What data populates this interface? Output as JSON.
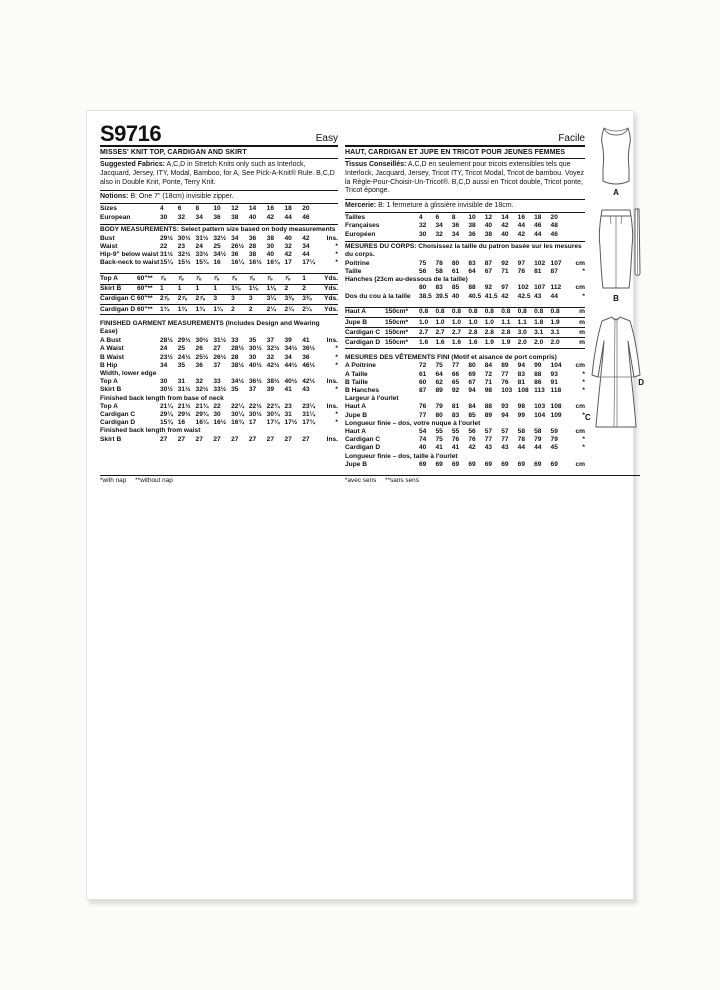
{
  "page": {
    "sku": "S9716"
  },
  "views": {
    "a": "A",
    "b": "B",
    "c": "C",
    "d": "D"
  },
  "english": {
    "difficulty": "Easy",
    "title": "MISSES' KNIT TOP, CARDIGAN AND SKIRT",
    "fabrics_label": "Suggested Fabrics:",
    "fabrics_text": "A,C,D in Stretch Knits only such as Interlock, Jacquard, Jersey, ITY, Modal, Bamboo, for A, See Pick-A-Knit® Rule. B,C,D also in Double Knit, Ponte, Terry Knit.",
    "notions_label": "Notions:",
    "notions_text": "B: One 7\" (18cm) invisible zipper.",
    "footnote": "*with nap     **without nap",
    "size_rows": [
      {
        "type": "row",
        "label": "Sizes",
        "values": [
          "4",
          "6",
          "8",
          "10",
          "12",
          "14",
          "16",
          "18",
          "20"
        ],
        "unit": ""
      },
      {
        "type": "row",
        "label": "European",
        "values": [
          "30",
          "32",
          "34",
          "36",
          "38",
          "40",
          "42",
          "44",
          "46"
        ],
        "unit": ""
      }
    ],
    "body_rows": [
      {
        "type": "header",
        "ruleTop": true,
        "text": "BODY MEASUREMENTS: Select pattern size based on body measurements"
      },
      {
        "type": "row",
        "label": "Bust",
        "values": [
          "29½",
          "30½",
          "31½",
          "32½",
          "34",
          "36",
          "38",
          "40",
          "42"
        ],
        "unit": "Ins."
      },
      {
        "type": "row",
        "label": "Waist",
        "values": [
          "22",
          "23",
          "24",
          "25",
          "26½",
          "28",
          "30",
          "32",
          "34"
        ],
        "unit": "*"
      },
      {
        "type": "row",
        "label": "Hip-9\" below waist",
        "values": [
          "31½",
          "32½",
          "33½",
          "34½",
          "36",
          "38",
          "40",
          "42",
          "44"
        ],
        "unit": "*"
      },
      {
        "type": "row",
        "label": "Back-neck to waist",
        "values": [
          "15¼",
          "15½",
          "15¾",
          "16",
          "16¼",
          "16½",
          "16¾",
          "17",
          "17¼"
        ],
        "unit": "*"
      }
    ],
    "yardage_rows": [
      {
        "type": "row",
        "ruleTop": true,
        "ruled": true,
        "label": "Top A",
        "spec": "60\"**",
        "values": [
          "⅞",
          "⅞",
          "⅞",
          "⅞",
          "⅞",
          "⅞",
          "⅞",
          "⅞",
          "1"
        ],
        "unit": "Yds."
      },
      {
        "type": "row",
        "ruled": true,
        "label": "Skirt B",
        "spec": "60\"**",
        "values": [
          "1",
          "1",
          "1",
          "1",
          "1⅛",
          "1⅛",
          "1⅛",
          "2",
          "2"
        ],
        "unit": "Yds."
      },
      {
        "type": "row",
        "ruled": true,
        "label": "Cardigan C",
        "spec": "60\"**",
        "values": [
          "2⅞",
          "2⅞",
          "2⅞",
          "3",
          "3",
          "3",
          "3¼",
          "3⅜",
          "3⅜"
        ],
        "unit": "Yds."
      },
      {
        "type": "row",
        "ruled": true,
        "label": "Cardigan D",
        "spec": "60\"**",
        "values": [
          "1¾",
          "1¾",
          "1¾",
          "1¾",
          "2",
          "2",
          "2¼",
          "2¼",
          "2¼"
        ],
        "unit": "Yds."
      }
    ],
    "finished_rows": [
      {
        "type": "header",
        "text": "FINISHED GARMENT MEASUREMENTS (Includes Design and Wearing Ease)"
      },
      {
        "type": "row",
        "label": "A Bust",
        "values": [
          "28½",
          "29½",
          "30½",
          "31½",
          "33",
          "35",
          "37",
          "39",
          "41"
        ],
        "unit": "Ins."
      },
      {
        "type": "row",
        "label": "A Waist",
        "values": [
          "24",
          "25",
          "26",
          "27",
          "28½",
          "30½",
          "32½",
          "34½",
          "36½"
        ],
        "unit": "*"
      },
      {
        "type": "row",
        "label": "B Waist",
        "values": [
          "23½",
          "24½",
          "25½",
          "26½",
          "28",
          "30",
          "32",
          "34",
          "36"
        ],
        "unit": "*"
      },
      {
        "type": "row",
        "label": "B Hip",
        "values": [
          "34",
          "35",
          "36",
          "37",
          "38½",
          "40½",
          "42½",
          "44½",
          "46½"
        ],
        "unit": "*"
      },
      {
        "type": "subhead",
        "text": "Width, lower edge"
      },
      {
        "type": "row",
        "label": "Top A",
        "values": [
          "30",
          "31",
          "32",
          "33",
          "34½",
          "36½",
          "38½",
          "40½",
          "42½"
        ],
        "unit": "Ins."
      },
      {
        "type": "row",
        "label": "Skirt B",
        "values": [
          "30½",
          "31½",
          "32½",
          "33½",
          "35",
          "37",
          "39",
          "41",
          "43"
        ],
        "unit": "*"
      },
      {
        "type": "subhead",
        "text": "Finished back length from base of neck"
      },
      {
        "type": "row",
        "label": "Top A",
        "values": [
          "21¼",
          "21½",
          "21¾",
          "22",
          "22¼",
          "22½",
          "22¾",
          "23",
          "23¼"
        ],
        "unit": "Ins."
      },
      {
        "type": "row",
        "label": "Cardigan C",
        "values": [
          "29¼",
          "29½",
          "29¾",
          "30",
          "30¼",
          "30½",
          "30¾",
          "31",
          "31¼"
        ],
        "unit": "*"
      },
      {
        "type": "row",
        "label": "Cardigan D",
        "values": [
          "15¾",
          "16",
          "16¼",
          "16½",
          "16¾",
          "17",
          "17¼",
          "17½",
          "17¾"
        ],
        "unit": "*"
      },
      {
        "type": "subhead",
        "text": "Finished back length from waist"
      },
      {
        "type": "row",
        "label": "Skirt B",
        "values": [
          "27",
          "27",
          "27",
          "27",
          "27",
          "27",
          "27",
          "27",
          "27"
        ],
        "unit": "Ins."
      }
    ]
  },
  "french": {
    "difficulty": "Facile",
    "title": "HAUT, CARDIGAN ET JUPE EN TRICOT POUR JEUNES FEMMES",
    "fabrics_label": "Tissus Conseillés:",
    "fabrics_text": "A,C,D en seulement pour tricots extensibles tels que Interlock, Jacquard, Jersey, Tricot ITY, Tricot Modal, Tricot de bambou. Voyez la Règle-Pour-Choisir-Un-Tricot®. B,C,D aussi en Tricot double, Tricot ponte, Tricot éponge.",
    "notions_label": "Mercerie:",
    "notions_text": "B: 1 fermeture à glissière invisible de 18cm.",
    "footnote": "*avec sens     **sans sens",
    "size_rows": [
      {
        "type": "row",
        "label": "Tailles",
        "values": [
          "4",
          "6",
          "8",
          "10",
          "12",
          "14",
          "16",
          "18",
          "20"
        ],
        "unit": ""
      },
      {
        "type": "row",
        "label": "Françaises",
        "values": [
          "32",
          "34",
          "36",
          "38",
          "40",
          "42",
          "44",
          "46",
          "48"
        ],
        "unit": ""
      },
      {
        "type": "row",
        "label": "Européen",
        "values": [
          "30",
          "32",
          "34",
          "36",
          "38",
          "40",
          "42",
          "44",
          "46"
        ],
        "unit": ""
      }
    ],
    "body_rows": [
      {
        "type": "header",
        "ruleTop": true,
        "text": "MESURES DU CORPS: Choisissez la taille du patron basée sur les mesures du corps."
      },
      {
        "type": "row",
        "label": "Poitrine",
        "values": [
          "75",
          "78",
          "80",
          "83",
          "87",
          "92",
          "97",
          "102",
          "107"
        ],
        "unit": "cm"
      },
      {
        "type": "row",
        "label": "Taille",
        "values": [
          "56",
          "58",
          "61",
          "64",
          "67",
          "71",
          "76",
          "81",
          "87"
        ],
        "unit": "*"
      },
      {
        "type": "subhead",
        "text": "Hanches (23cm au-dessous de la taille)"
      },
      {
        "type": "row",
        "label": "",
        "values": [
          "80",
          "83",
          "85",
          "88",
          "92",
          "97",
          "102",
          "107",
          "112"
        ],
        "unit": "cm"
      },
      {
        "type": "row",
        "label": "Dos du cou à la taille",
        "values": [
          "38.5",
          "39.5",
          "40",
          "40.5",
          "41.5",
          "42",
          "42.5",
          "43",
          "44"
        ],
        "unit": "*"
      }
    ],
    "yardage_rows": [
      {
        "type": "row",
        "ruleTop": true,
        "ruled": true,
        "label": "Haut A",
        "spec": "150cm*",
        "values": [
          "0.8",
          "0.8",
          "0.8",
          "0.8",
          "0.8",
          "0.8",
          "0.8",
          "0.8",
          "0.8"
        ],
        "unit": "m"
      },
      {
        "type": "row",
        "ruled": true,
        "label": "Jupe B",
        "spec": "150cm*",
        "values": [
          "1.0",
          "1.0",
          "1.0",
          "1.0",
          "1.0",
          "1.1",
          "1.1",
          "1.8",
          "1.9"
        ],
        "unit": "m"
      },
      {
        "type": "row",
        "ruled": true,
        "label": "Cardigan C",
        "spec": "150cm*",
        "values": [
          "2.7",
          "2.7",
          "2.7",
          "2.8",
          "2.8",
          "2.8",
          "3.0",
          "3.1",
          "3.1"
        ],
        "unit": "m"
      },
      {
        "type": "row",
        "ruled": true,
        "label": "Cardigan D",
        "spec": "150cm*",
        "values": [
          "1.6",
          "1.6",
          "1.6",
          "1.6",
          "1.9",
          "1.9",
          "2.0",
          "2.0",
          "2.0"
        ],
        "unit": "m"
      }
    ],
    "finished_rows": [
      {
        "type": "header",
        "text": "MESURES DES VÊTEMENTS FINI (Motif et aisance de port compris)"
      },
      {
        "type": "row",
        "label": "A Poitrine",
        "values": [
          "72",
          "75",
          "77",
          "80",
          "84",
          "89",
          "94",
          "99",
          "104"
        ],
        "unit": "cm"
      },
      {
        "type": "row",
        "label": "A Taille",
        "values": [
          "61",
          "64",
          "66",
          "69",
          "72",
          "77",
          "83",
          "88",
          "93"
        ],
        "unit": "*"
      },
      {
        "type": "row",
        "label": "B Taille",
        "values": [
          "60",
          "62",
          "65",
          "67",
          "71",
          "76",
          "81",
          "86",
          "91"
        ],
        "unit": "*"
      },
      {
        "type": "row",
        "label": "B Hanches",
        "values": [
          "87",
          "89",
          "92",
          "94",
          "98",
          "103",
          "108",
          "113",
          "118"
        ],
        "unit": "*"
      },
      {
        "type": "subhead",
        "text": "Largeur à l'ourlet"
      },
      {
        "type": "row",
        "label": "Haut A",
        "values": [
          "76",
          "79",
          "81",
          "84",
          "88",
          "93",
          "98",
          "103",
          "108"
        ],
        "unit": "cm"
      },
      {
        "type": "row",
        "label": "Jupe B",
        "values": [
          "77",
          "80",
          "83",
          "85",
          "89",
          "94",
          "99",
          "104",
          "109"
        ],
        "unit": "*"
      },
      {
        "type": "subhead",
        "text": "Longueur finie – dos, votre nuque à l'ourlet"
      },
      {
        "type": "row",
        "label": "Haut A",
        "values": [
          "54",
          "55",
          "55",
          "56",
          "57",
          "57",
          "58",
          "58",
          "59"
        ],
        "unit": "cm"
      },
      {
        "type": "row",
        "label": "Cardigan C",
        "values": [
          "74",
          "75",
          "76",
          "76",
          "77",
          "77",
          "78",
          "79",
          "79"
        ],
        "unit": "*"
      },
      {
        "type": "row",
        "label": "Cardigan D",
        "values": [
          "40",
          "41",
          "41",
          "42",
          "43",
          "43",
          "44",
          "44",
          "45"
        ],
        "unit": "*"
      },
      {
        "type": "subhead",
        "text": "Longueur finie – dos, taille à l'ourlet"
      },
      {
        "type": "row",
        "label": "Jupe B",
        "values": [
          "69",
          "69",
          "69",
          "69",
          "69",
          "69",
          "69",
          "69",
          "69"
        ],
        "unit": "cm"
      }
    ]
  }
}
